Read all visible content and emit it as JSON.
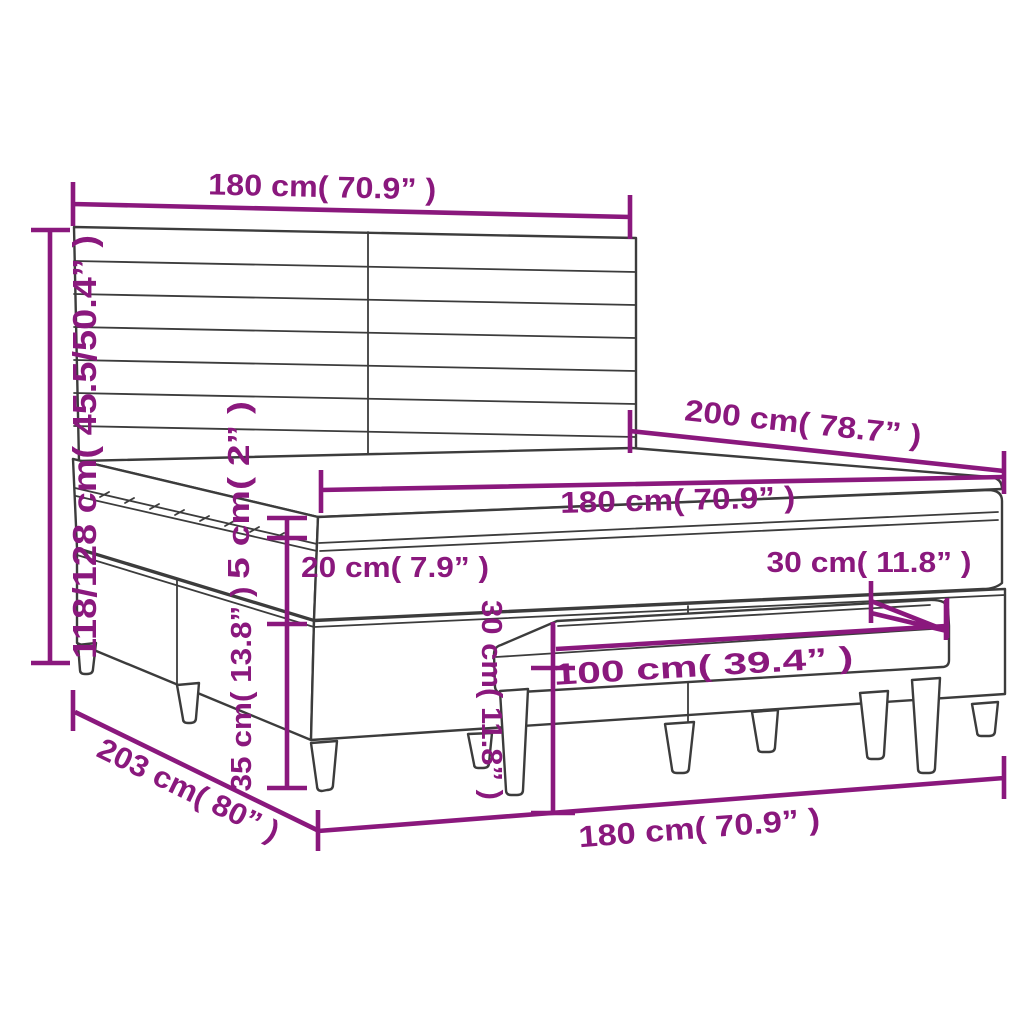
{
  "diagram": {
    "type": "furniture-dimension-diagram",
    "subject": "box-spring-bed-with-headboard-and-bench",
    "colors": {
      "accent": "#8A187D",
      "line": "#3C3C3C",
      "background": "#FFFFFF"
    },
    "dims": {
      "headboard_width": "180 cm( 70.9” )",
      "overall_height": "118/128 cm( 45.5/50.4” )",
      "bed_length": "200 cm( 78.7” )",
      "mattress_width": "180 cm( 70.9” )",
      "topper_thickness": "5 cm( 2” )",
      "mattress_thickness": "20 cm( 7.9” )",
      "base_height": "35 cm( 13.8” )",
      "frame_length": "203 cm( 80” )",
      "frame_width": "180 cm( 70.9” )",
      "bench_length": "100 cm( 39.4” )",
      "bench_height": "30 cm( 11.8” )",
      "bench_depth": "30 cm( 11.8” )"
    }
  }
}
